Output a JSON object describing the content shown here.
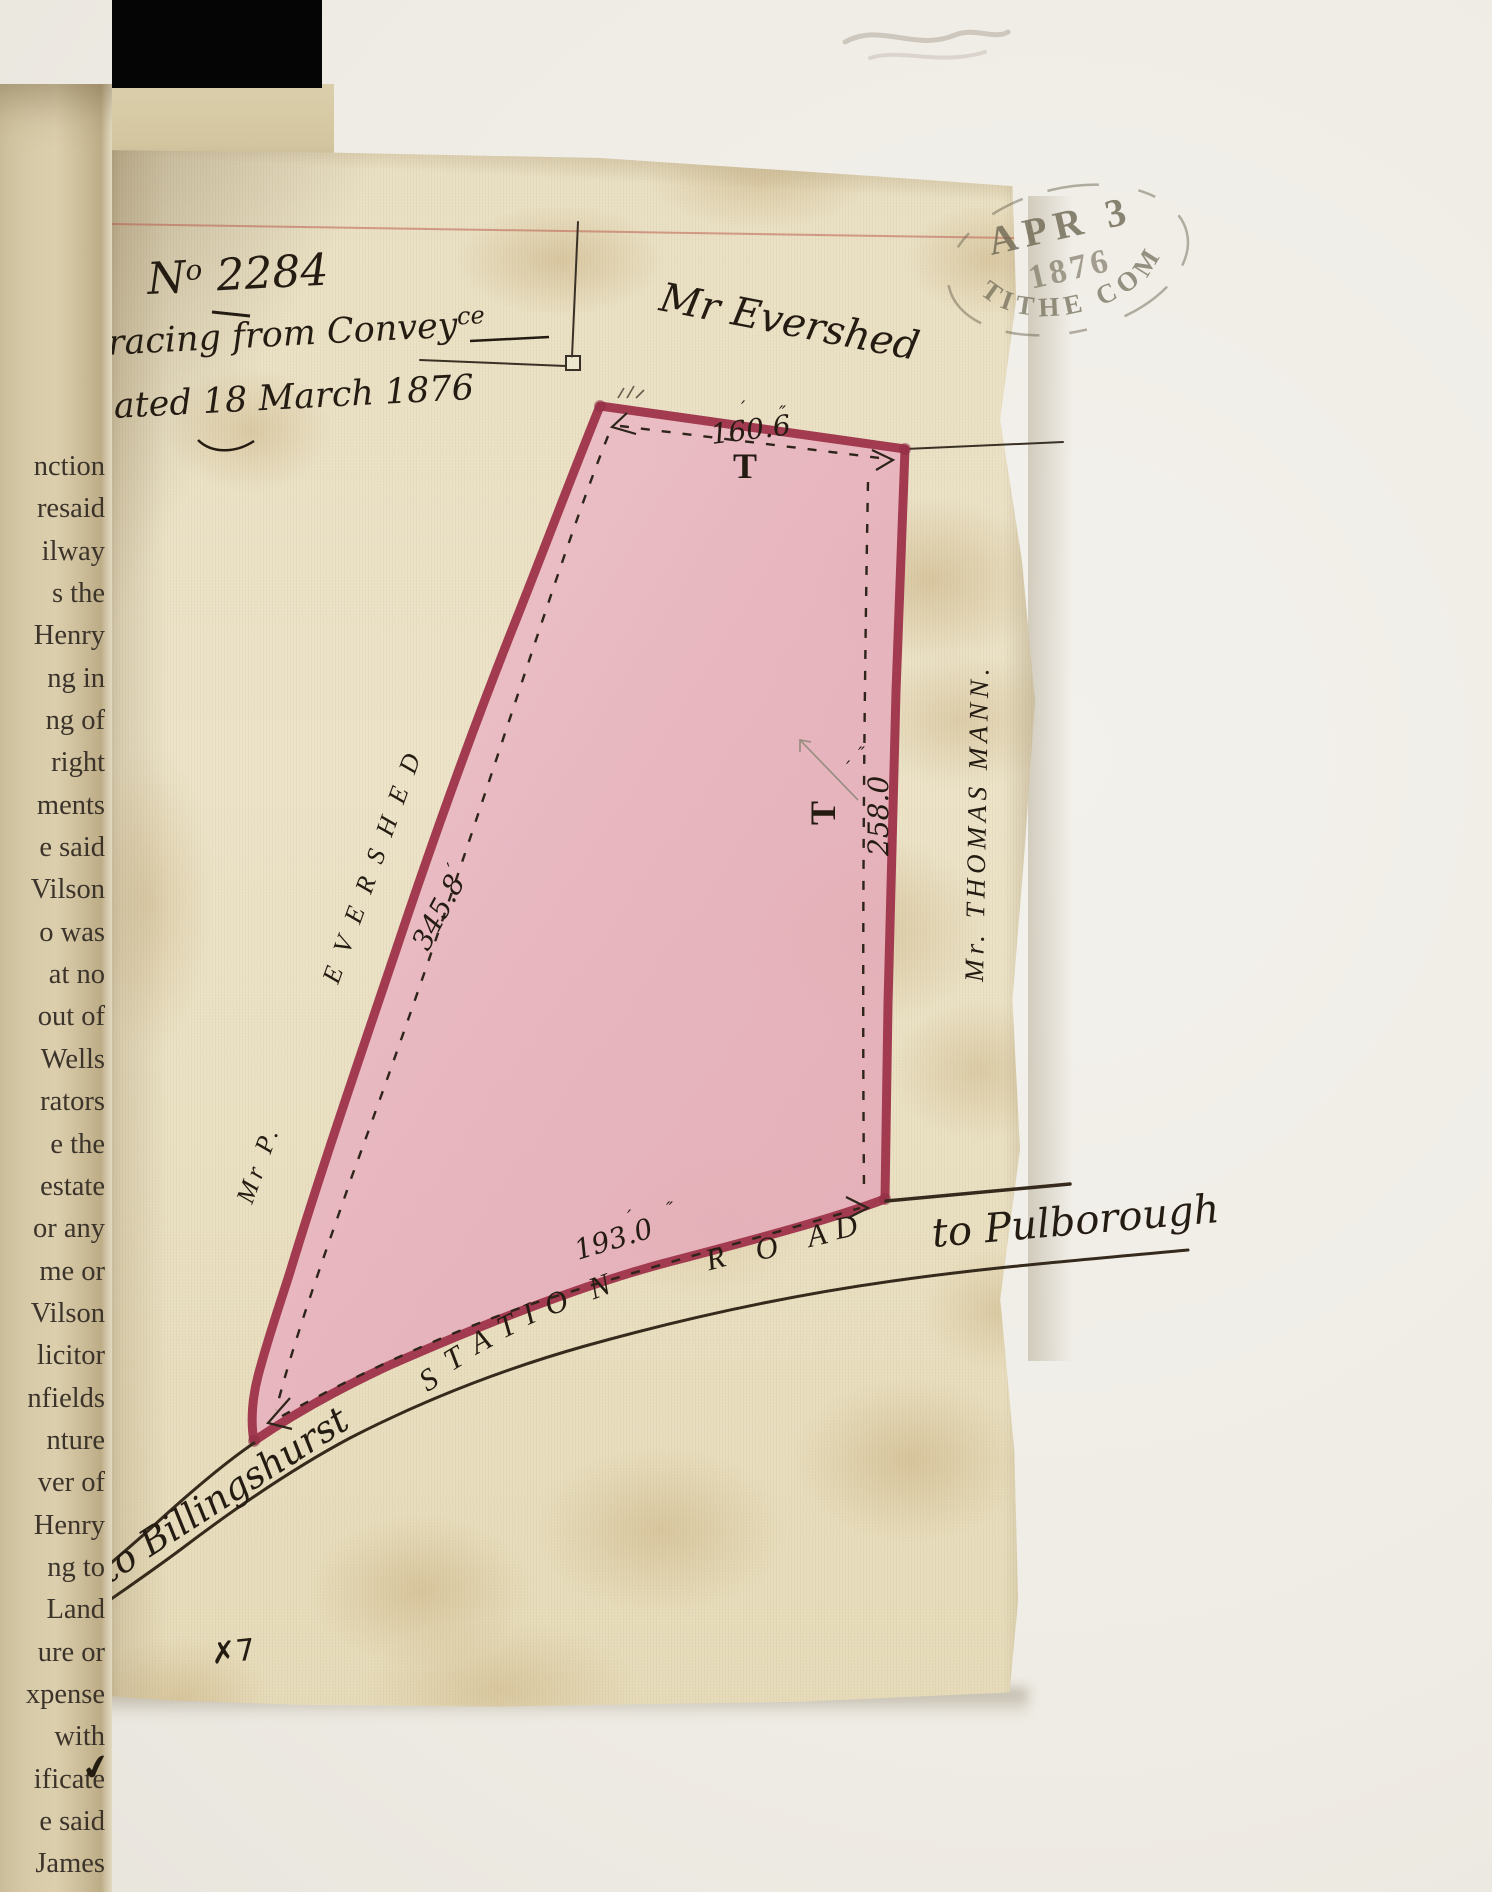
{
  "book_page": {
    "lines": [
      "nction",
      "resaid",
      "ilway",
      "s the",
      "Henry",
      "ng in",
      "ng of",
      "right",
      "ments",
      "e said",
      "Vilson",
      "o was",
      "at no",
      "out of",
      "Wells",
      "rators",
      "e the",
      "estate",
      "or any",
      "me or",
      "Vilson",
      "licitor",
      "nfields",
      "nture",
      "ver of",
      "Henry",
      "ng to",
      "Land",
      "ure or",
      "xpense",
      "with",
      "ificate",
      "e said",
      "James"
    ],
    "ink_tick": "✔"
  },
  "map": {
    "ref_prefix": "N",
    "ref_sup": "o",
    "ref_digits": " 2284",
    "title_line1": "Tracing from Convey",
    "title_line1_sup": "ce",
    "title_line2": "dated 18 March 1876",
    "stamp": {
      "top": "APR 3",
      "middle": "1876",
      "bottom": "TITHE COM"
    },
    "owner_top": "Mr Evershed",
    "owner_left_prefix": "Mr P.",
    "owner_left_name": "EVERSHED",
    "owner_right": "Mr. THOMAS MANN.",
    "t_mark": "T",
    "dims": {
      "top": "160.6",
      "left": "345.8",
      "right": "258.0",
      "bottom": "193.0"
    },
    "prime": "′",
    "double_prime": "″",
    "road_letters": [
      "S",
      "T",
      "A",
      "T",
      "I",
      "O",
      "N",
      "R",
      "O",
      "A",
      "D"
    ],
    "dest_right": "to Pulborough",
    "dest_left": "to Billingshurst",
    "surveyor_mark": "✗7",
    "colors": {
      "parcel_fill": "#e8b5bf",
      "boundary_red": "#a23a50",
      "ink": "#2b2115",
      "stamp": "#6e6853"
    }
  }
}
